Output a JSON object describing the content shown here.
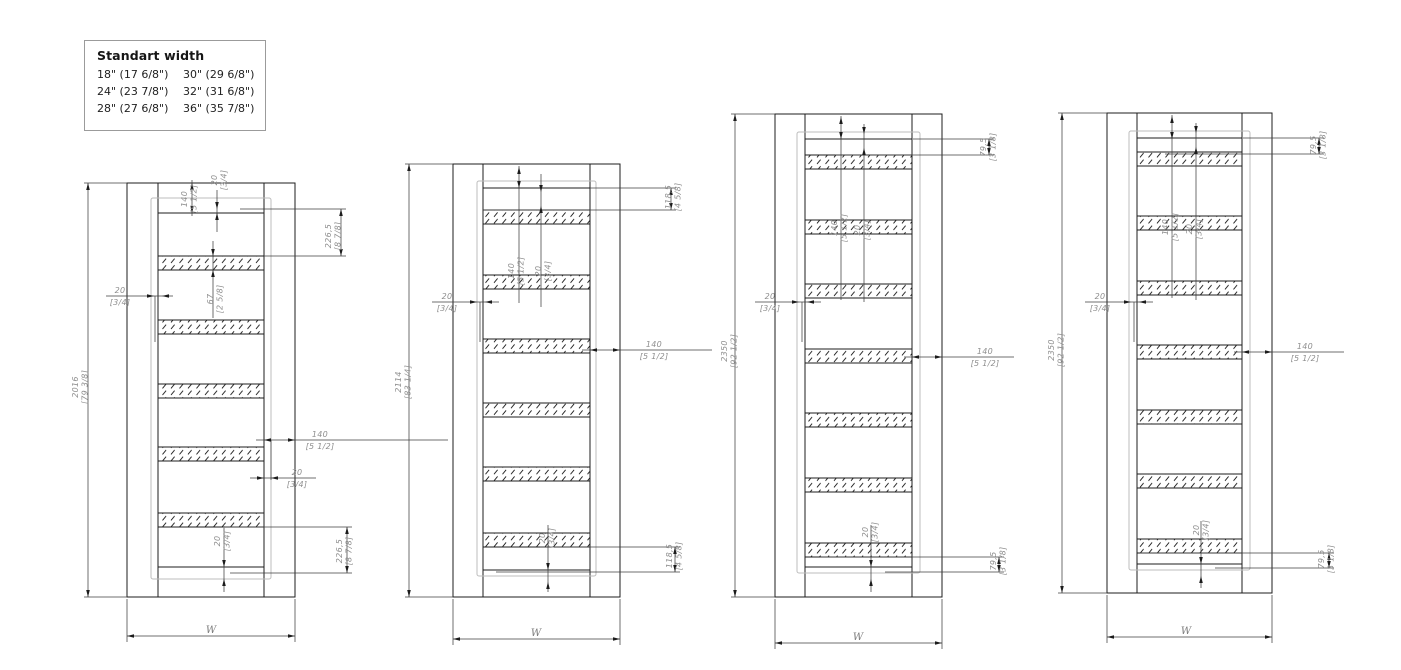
{
  "colors": {
    "line": "#1c1c1c",
    "dim": "#3f3f3f",
    "seal": "#bcbcbc",
    "text": "#8f8f8f",
    "legendBorder": "#9b9b9b"
  },
  "legend": {
    "title": "Standart width",
    "rows": [
      [
        "18\" (17 6/8\")",
        "30\" (29 6/8\")"
      ],
      [
        "24\" (23 7/8\")",
        "32\" (31 6/8\")"
      ],
      [
        "28\" (27 6/8\")",
        "36\" (35 7/8\")"
      ]
    ]
  },
  "doors": [
    {
      "name": "door-elevation-1",
      "frame": [
        127,
        183,
        295,
        597
      ],
      "jambs": [
        158,
        264
      ],
      "leaf": [
        213,
        567
      ],
      "seal": [
        151,
        198,
        271,
        579
      ],
      "band_h": 14,
      "bands": [
        256,
        320,
        384,
        447,
        513
      ],
      "dim_lines": [
        [
          127,
          183,
          84,
          183
        ],
        [
          127,
          597,
          84,
          597
        ],
        [
          88,
          183,
          88,
          597
        ],
        [
          192,
          180,
          192,
          216
        ],
        [
          217,
          190,
          217,
          232
        ],
        [
          240,
          209,
          346,
          209
        ],
        [
          264,
          256,
          346,
          256
        ],
        [
          341,
          209,
          341,
          256
        ],
        [
          213,
          241,
          213,
          318
        ],
        [
          106,
          296,
          173,
          296
        ],
        [
          155,
          296,
          155,
          342
        ],
        [
          256,
          440,
          448,
          440
        ],
        [
          271,
          440,
          271,
          480
        ],
        [
          250,
          478,
          316,
          478
        ],
        [
          225,
          527,
          352,
          527
        ],
        [
          230,
          573,
          352,
          573
        ],
        [
          347,
          527,
          347,
          573
        ],
        [
          224,
          528,
          224,
          592
        ],
        [
          127,
          599,
          127,
          642
        ],
        [
          295,
          599,
          295,
          642
        ],
        [
          127,
          636,
          295,
          636
        ]
      ],
      "arrows": [
        [
          88,
          183,
          "u"
        ],
        [
          88,
          597,
          "d"
        ],
        [
          192,
          183,
          "u"
        ],
        [
          192,
          213,
          "d"
        ],
        [
          217,
          209,
          "d"
        ],
        [
          217,
          213,
          "u"
        ],
        [
          341,
          209,
          "u"
        ],
        [
          341,
          256,
          "d"
        ],
        [
          213,
          256,
          "d"
        ],
        [
          213,
          270,
          "u"
        ],
        [
          154,
          296,
          "r"
        ],
        [
          162,
          296,
          "l"
        ],
        [
          264,
          440,
          "l"
        ],
        [
          295,
          440,
          "r"
        ],
        [
          264,
          478,
          "r"
        ],
        [
          271,
          478,
          "l"
        ],
        [
          347,
          527,
          "u"
        ],
        [
          347,
          573,
          "d"
        ],
        [
          224,
          567,
          "d"
        ],
        [
          224,
          579,
          "u"
        ],
        [
          127,
          636,
          "l"
        ],
        [
          295,
          636,
          "r"
        ]
      ],
      "labels": [
        {
          "name": "dim-height-2016",
          "v": "2016",
          "b": "[79 3/8]",
          "x": 80,
          "y": 387,
          "rot": true
        },
        {
          "name": "dim-140-top",
          "v": "140",
          "b": "[5 1/2]",
          "x": 189,
          "y": 199,
          "rot": true
        },
        {
          "name": "dim-20-top",
          "v": "20",
          "b": "[3/4]",
          "x": 219,
          "y": 180,
          "rot": true
        },
        {
          "name": "dim-226-top",
          "v": "226,5",
          "b": "[8 7/8]",
          "x": 333,
          "y": 236,
          "rot": true
        },
        {
          "name": "dim-67-band",
          "v": "67",
          "b": "[2 5/8]",
          "x": 215,
          "y": 299,
          "rot": true
        },
        {
          "name": "dim-20-left",
          "v": "20",
          "b": "[3/4]",
          "x": 120,
          "y": 296
        },
        {
          "name": "dim-140-right",
          "v": "140",
          "b": "[5 1/2]",
          "x": 320,
          "y": 440
        },
        {
          "name": "dim-20-right",
          "v": "20",
          "b": "[3/4]",
          "x": 297,
          "y": 478
        },
        {
          "name": "dim-226-bottom",
          "v": "226,5",
          "b": "[8 7/8]",
          "x": 344,
          "y": 551,
          "rot": true
        },
        {
          "name": "dim-20-bottom",
          "v": "20",
          "b": "[3/4]",
          "x": 222,
          "y": 541,
          "rot": true
        },
        {
          "name": "dim-width-w",
          "v": "W",
          "b": "",
          "x": 211,
          "y": 633
        }
      ]
    },
    {
      "name": "door-elevation-2",
      "frame": [
        453,
        164,
        620,
        597
      ],
      "jambs": [
        483,
        590
      ],
      "leaf": [
        188,
        570
      ],
      "seal": [
        477,
        181,
        596,
        576
      ],
      "band_h": 14,
      "bands": [
        210,
        275,
        339,
        403,
        467,
        533
      ],
      "dim_lines": [
        [
          453,
          164,
          405,
          164
        ],
        [
          453,
          597,
          405,
          597
        ],
        [
          409,
          164,
          409,
          597
        ],
        [
          519,
          166,
          519,
          303
        ],
        [
          541,
          174,
          541,
          307
        ],
        [
          590,
          188,
          676,
          188
        ],
        [
          483,
          210,
          676,
          210
        ],
        [
          671,
          188,
          671,
          210
        ],
        [
          432,
          302,
          499,
          302
        ],
        [
          480,
          302,
          480,
          342
        ],
        [
          582,
          350,
          712,
          350
        ],
        [
          540,
          547,
          680,
          547
        ],
        [
          496,
          572,
          680,
          572
        ],
        [
          675,
          547,
          675,
          572
        ],
        [
          548,
          525,
          548,
          592
        ],
        [
          453,
          599,
          453,
          645
        ],
        [
          620,
          599,
          620,
          645
        ],
        [
          453,
          639,
          620,
          639
        ]
      ],
      "arrows": [
        [
          409,
          164,
          "u"
        ],
        [
          409,
          597,
          "d"
        ],
        [
          519,
          167,
          "u"
        ],
        [
          519,
          188,
          "d"
        ],
        [
          541,
          192,
          "d"
        ],
        [
          541,
          206,
          "u"
        ],
        [
          671,
          188,
          "u"
        ],
        [
          671,
          210,
          "d"
        ],
        [
          477,
          302,
          "r"
        ],
        [
          485,
          302,
          "l"
        ],
        [
          590,
          350,
          "l"
        ],
        [
          620,
          350,
          "r"
        ],
        [
          675,
          547,
          "u"
        ],
        [
          675,
          572,
          "d"
        ],
        [
          548,
          570,
          "d"
        ],
        [
          548,
          582,
          "u"
        ],
        [
          453,
          639,
          "l"
        ],
        [
          620,
          639,
          "r"
        ]
      ],
      "labels": [
        {
          "name": "dim-height-2114",
          "v": "2114",
          "b": "[83 1/4]",
          "x": 403,
          "y": 382,
          "rot": true
        },
        {
          "name": "dim-140-mid",
          "v": "140",
          "b": "[5 1/2]",
          "x": 516,
          "y": 271,
          "rot": true
        },
        {
          "name": "dim-20-mid",
          "v": "20",
          "b": "[3/4]",
          "x": 543,
          "y": 271,
          "rot": true
        },
        {
          "name": "dim-118-top",
          "v": "118,5",
          "b": "[4 5/8]",
          "x": 673,
          "y": 197,
          "rot": true
        },
        {
          "name": "dim-20-left",
          "v": "20",
          "b": "[3/4]",
          "x": 447,
          "y": 302
        },
        {
          "name": "dim-140-right",
          "v": "140",
          "b": "[5 1/2]",
          "x": 654,
          "y": 350
        },
        {
          "name": "dim-118-bottom",
          "v": "118,5",
          "b": "[4 5/8]",
          "x": 674,
          "y": 556,
          "rot": true
        },
        {
          "name": "dim-20-bottom",
          "v": "20",
          "b": "[3/4]",
          "x": 547,
          "y": 538,
          "rot": true
        },
        {
          "name": "dim-width-w",
          "v": "W",
          "b": "",
          "x": 536,
          "y": 636
        }
      ]
    },
    {
      "name": "door-elevation-3",
      "frame": [
        775,
        114,
        942,
        597
      ],
      "jambs": [
        805,
        912
      ],
      "leaf": [
        139,
        567
      ],
      "seal": [
        797,
        132,
        920,
        573
      ],
      "band_h": 14,
      "bands": [
        155,
        220,
        284,
        349,
        413,
        478,
        543
      ],
      "dim_lines": [
        [
          775,
          114,
          731,
          114
        ],
        [
          775,
          597,
          731,
          597
        ],
        [
          735,
          114,
          735,
          597
        ],
        [
          841,
          116,
          841,
          300
        ],
        [
          864,
          124,
          864,
          302
        ],
        [
          913,
          139,
          994,
          139
        ],
        [
          835,
          155,
          994,
          155
        ],
        [
          989,
          139,
          989,
          155
        ],
        [
          755,
          302,
          821,
          302
        ],
        [
          802,
          302,
          802,
          342
        ],
        [
          904,
          357,
          1014,
          357
        ],
        [
          820,
          557,
          1004,
          557
        ],
        [
          885,
          572,
          1004,
          572
        ],
        [
          999,
          557,
          999,
          572
        ],
        [
          871,
          525,
          871,
          592
        ],
        [
          775,
          599,
          775,
          649
        ],
        [
          942,
          599,
          942,
          649
        ],
        [
          775,
          643,
          942,
          643
        ]
      ],
      "arrows": [
        [
          735,
          114,
          "u"
        ],
        [
          735,
          597,
          "d"
        ],
        [
          841,
          117,
          "u"
        ],
        [
          841,
          139,
          "d"
        ],
        [
          864,
          134,
          "d"
        ],
        [
          864,
          148,
          "u"
        ],
        [
          989,
          139,
          "u"
        ],
        [
          989,
          155,
          "d"
        ],
        [
          799,
          302,
          "r"
        ],
        [
          807,
          302,
          "l"
        ],
        [
          912,
          357,
          "l"
        ],
        [
          942,
          357,
          "r"
        ],
        [
          999,
          557,
          "u"
        ],
        [
          999,
          572,
          "d"
        ],
        [
          871,
          567,
          "d"
        ],
        [
          871,
          579,
          "u"
        ],
        [
          775,
          643,
          "l"
        ],
        [
          942,
          643,
          "r"
        ]
      ],
      "labels": [
        {
          "name": "dim-height-2350",
          "v": "2350",
          "b": "[92 1/2]",
          "x": 729,
          "y": 351,
          "rot": true
        },
        {
          "name": "dim-140-mid",
          "v": "140",
          "b": "[5 1/2]",
          "x": 839,
          "y": 228,
          "rot": true
        },
        {
          "name": "dim-20-mid",
          "v": "20",
          "b": "[3/4]",
          "x": 862,
          "y": 230,
          "rot": true
        },
        {
          "name": "dim-79-top",
          "v": "79,5",
          "b": "[3 1/8]",
          "x": 988,
          "y": 147,
          "rot": true
        },
        {
          "name": "dim-20-left",
          "v": "20",
          "b": "[3/4]",
          "x": 770,
          "y": 302
        },
        {
          "name": "dim-140-right",
          "v": "140",
          "b": "[5 1/2]",
          "x": 985,
          "y": 357
        },
        {
          "name": "dim-79-bottom",
          "v": "79,5",
          "b": "[3 1/8]",
          "x": 998,
          "y": 561,
          "rot": true
        },
        {
          "name": "dim-20-bottom",
          "v": "20",
          "b": "[3/4]",
          "x": 870,
          "y": 532,
          "rot": true
        },
        {
          "name": "dim-width-w",
          "v": "W",
          "b": "",
          "x": 858,
          "y": 640
        }
      ]
    },
    {
      "name": "door-elevation-4",
      "frame": [
        1107,
        113,
        1272,
        593
      ],
      "jambs": [
        1137,
        1242
      ],
      "leaf": [
        138,
        564
      ],
      "seal": [
        1129,
        131,
        1250,
        570
      ],
      "band_h": 14,
      "bands": [
        152,
        216,
        281,
        345,
        410,
        474,
        539
      ],
      "dim_lines": [
        [
          1107,
          113,
          1058,
          113
        ],
        [
          1107,
          593,
          1058,
          593
        ],
        [
          1062,
          113,
          1062,
          593
        ],
        [
          1172,
          115,
          1172,
          298
        ],
        [
          1196,
          123,
          1196,
          300
        ],
        [
          1243,
          138,
          1324,
          138
        ],
        [
          1165,
          154,
          1324,
          154
        ],
        [
          1319,
          138,
          1319,
          154
        ],
        [
          1085,
          302,
          1153,
          302
        ],
        [
          1134,
          302,
          1134,
          342
        ],
        [
          1234,
          352,
          1344,
          352
        ],
        [
          1140,
          553,
          1334,
          553
        ],
        [
          1215,
          568,
          1334,
          568
        ],
        [
          1329,
          553,
          1329,
          568
        ],
        [
          1201,
          521,
          1201,
          588
        ],
        [
          1107,
          595,
          1107,
          643
        ],
        [
          1272,
          595,
          1272,
          643
        ],
        [
          1107,
          637,
          1272,
          637
        ]
      ],
      "arrows": [
        [
          1062,
          113,
          "u"
        ],
        [
          1062,
          593,
          "d"
        ],
        [
          1172,
          116,
          "u"
        ],
        [
          1172,
          139,
          "d"
        ],
        [
          1196,
          133,
          "d"
        ],
        [
          1196,
          147,
          "u"
        ],
        [
          1319,
          138,
          "u"
        ],
        [
          1319,
          154,
          "d"
        ],
        [
          1131,
          302,
          "r"
        ],
        [
          1139,
          302,
          "l"
        ],
        [
          1242,
          352,
          "l"
        ],
        [
          1272,
          352,
          "r"
        ],
        [
          1329,
          553,
          "u"
        ],
        [
          1329,
          568,
          "d"
        ],
        [
          1201,
          564,
          "d"
        ],
        [
          1201,
          576,
          "u"
        ],
        [
          1107,
          637,
          "l"
        ],
        [
          1272,
          637,
          "r"
        ]
      ],
      "labels": [
        {
          "name": "dim-height-2350",
          "v": "2350",
          "b": "[92 1/2]",
          "x": 1056,
          "y": 350,
          "rot": true
        },
        {
          "name": "dim-140-mid",
          "v": "140",
          "b": "[5 1/2]",
          "x": 1170,
          "y": 227,
          "rot": true
        },
        {
          "name": "dim-20-mid",
          "v": "20",
          "b": "[3/4]",
          "x": 1194,
          "y": 229,
          "rot": true
        },
        {
          "name": "dim-79-top",
          "v": "79,5",
          "b": "[3 1/8]",
          "x": 1318,
          "y": 145,
          "rot": true
        },
        {
          "name": "dim-20-left",
          "v": "20",
          "b": "[3/4]",
          "x": 1100,
          "y": 302
        },
        {
          "name": "dim-140-right",
          "v": "140",
          "b": "[5 1/2]",
          "x": 1305,
          "y": 352
        },
        {
          "name": "dim-79-bottom",
          "v": "79,5",
          "b": "[3 1/8]",
          "x": 1326,
          "y": 559,
          "rot": true
        },
        {
          "name": "dim-20-bottom",
          "v": "20",
          "b": "[3/4]",
          "x": 1201,
          "y": 530,
          "rot": true
        },
        {
          "name": "dim-width-w",
          "v": "W",
          "b": "",
          "x": 1186,
          "y": 634
        }
      ]
    }
  ]
}
